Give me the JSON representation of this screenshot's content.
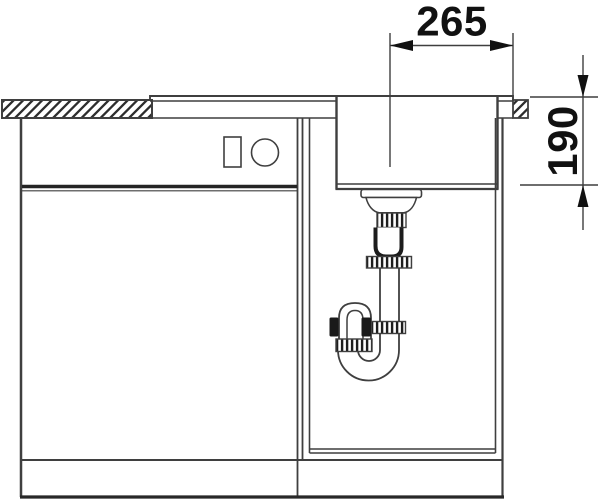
{
  "drawing": {
    "dim_horizontal": "265",
    "dim_vertical": "190"
  },
  "colors": {
    "line": "#3f3f3f",
    "dark": "#1f1f1f",
    "text": "#111111",
    "background": "#ffffff"
  }
}
